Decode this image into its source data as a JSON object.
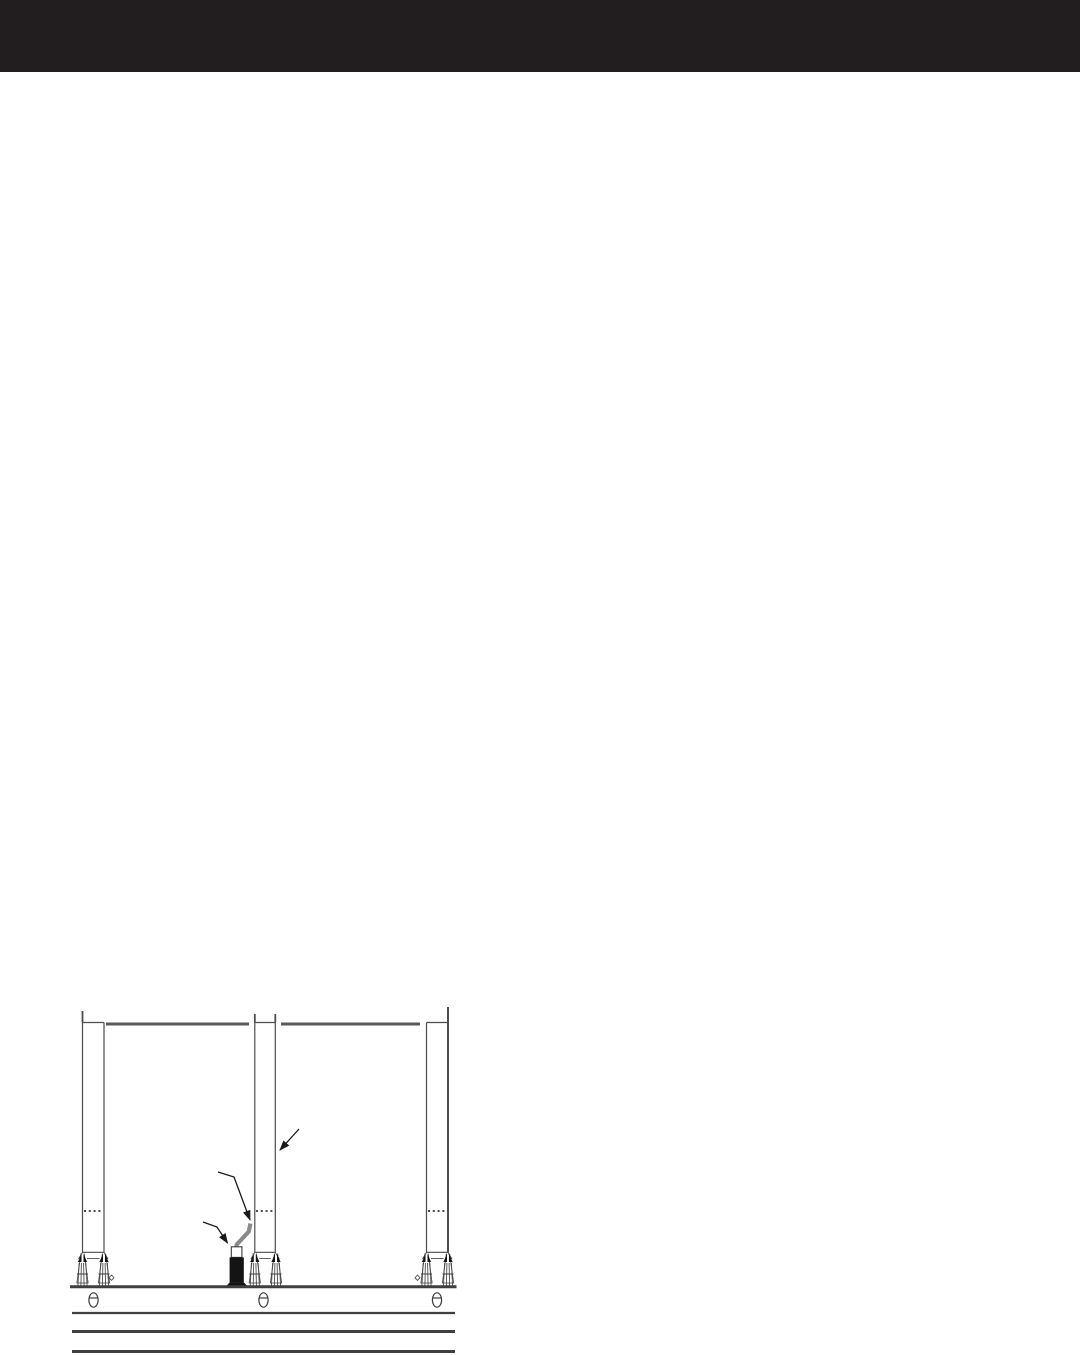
{
  "page": {
    "background_color": "#ffffff",
    "width_px": 1080,
    "height_px": 1355
  },
  "header": {
    "band_color": "#221e1f",
    "height_px": 72
  },
  "figure": {
    "kind": "technical-line-drawing",
    "subject": "panel-installation-elevation",
    "line_color": "#4a4a4a",
    "rail_color": "#5a5a5a",
    "conduit_color": "#8a8a8a",
    "device_color": "#141414",
    "arrow_color": "#1a1a1a",
    "post_count": 3,
    "panel_count": 2,
    "floor_anchor_count": 3,
    "diamond_marker_count": 2,
    "callout_arrow_count": 3,
    "callout_targets": [
      "panel-post",
      "conduit",
      "floor-feed-device"
    ],
    "ground_rule_count": 3
  }
}
